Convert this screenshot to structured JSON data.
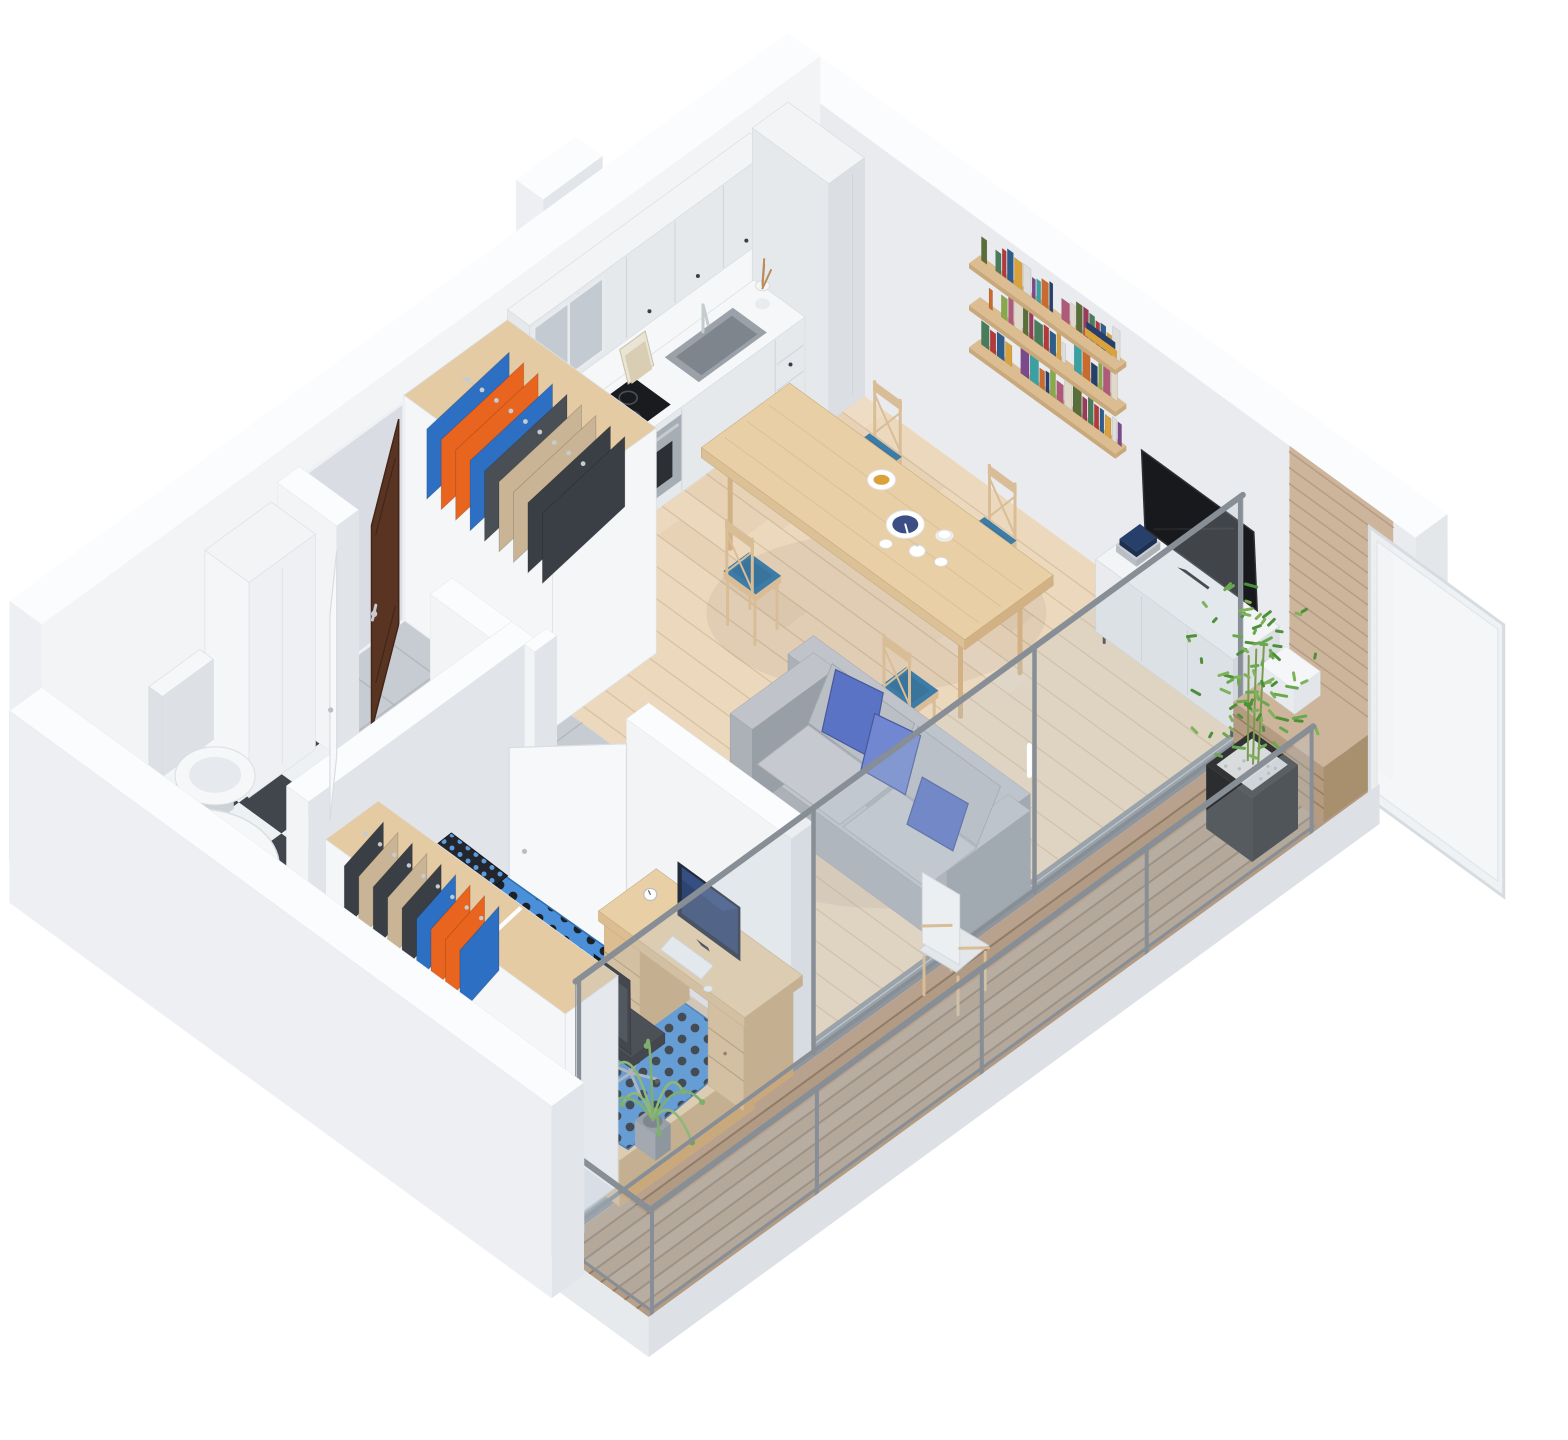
{
  "scene": {
    "kind": "isometric-3d-apartment-floor-plan-render",
    "background": "#ffffff",
    "rooms": [
      "kitchen",
      "living-dining",
      "hallway",
      "bathroom",
      "bedroom",
      "balcony"
    ]
  },
  "colors": {
    "bg": "#ffffff",
    "wallTop": "#fbfcfd",
    "wallInnerTL": "#f3f4f6",
    "wallInnerTR": "#e9ebee",
    "wallEnd": "#e4e7ea",
    "wallOuterFront": "#edeff2",
    "wallOuterShade": "#e2e5e9",
    "slabEdge": "#e7eaed",
    "partTop": "#fbfcfd",
    "partFace": "#f2f4f6",
    "partSide": "#e1e4e8",
    "floorWood": "#ecd8bd",
    "plankLine": "#d9c2a3",
    "tileBase": "#c6ccd1",
    "tileLine": "#b3b9bf",
    "checkerDark": "#41464d",
    "checkerLight": "#eef1f3",
    "deckBase": "#b29b84",
    "deckLine": "#8d7763",
    "cabinetFront": "#e6e9ec",
    "cabinetSide": "#dbdfe3",
    "cabinetTop": "#f2f4f6",
    "counterTop": "#f5f7f9",
    "glassCabinet": "#c4cad1",
    "cooktop": "#191b1e",
    "burnerRing": "#4a5057",
    "ovenSteel": "#a7adb4",
    "ovenGlass": "#2c2f34",
    "sinkOuter": "#9aa1a8",
    "sinkInner": "#7e858c",
    "chrome": "#c6cbd0",
    "tableWood": "#e8cfa6",
    "tableWoodSide": "#dcc096",
    "tableWoodDark": "#d2b284",
    "chairWood": "#d9bd97",
    "chairBlue": "#3d7ca6",
    "chairBlueDark": "#33688c",
    "sofaBody": "#c0c4ca",
    "sofaShade": "#acb1b8",
    "sofaDark": "#999fa7",
    "pillowBlue": "#5b73c4",
    "pillowBlueLight": "#7187d2",
    "pillowBlueDark": "#47599c",
    "bedBlue": "#4a8fd7",
    "bedBlueEdge": "#2f6fb2",
    "bedDotDark": "#1c2127",
    "pillowDark": "#23262c",
    "pillowDotBlue": "#5a9be0",
    "woodLight": "#e9cfa6",
    "woodMid": "#dcbd92",
    "woodDark": "#c9a87b",
    "woodInterior": "#e5cba4",
    "doorBrown": "#5a3423",
    "doorBrownDark": "#422619",
    "doorWhite": "#f7f8fa",
    "doorWhiteEdge": "#d9dde2",
    "recess": "#d9dde3",
    "tvBlack": "#17191c",
    "tvEdge": "#2e3237",
    "monitorFrame": "#232c3c",
    "monitorScreen": "#2e4470",
    "monitorGlow": "#3d5a94",
    "chairBlack": "#26292e",
    "chairBlackDark": "#1b1d21",
    "chromeLeg": "#aab0b6",
    "planterBlack": "#2b2d2f",
    "planterSide": "#232527",
    "pebbles": "#d9dbdd",
    "green1": "#4e8f3a",
    "green2": "#6aa84f",
    "green3": "#7fb25a",
    "trunk": "#7a9a4e",
    "slatWood": "#cdb59c",
    "slatLine": "#b49b81",
    "railFrame": "#878e95",
    "railGlass": "#bac6d0",
    "frostedGlass": "#eef1f4",
    "frostedFrame": "#d7dce1",
    "fixtureWhite": "#f5f7f9",
    "fixtureShade": "#dde1e5",
    "fixtureInner": "#e6eaee",
    "trackGray": "#8f969d",
    "shadow": "#1f2933"
  },
  "palettes": {
    "books": [
      "#4a7c59",
      "#b23a3a",
      "#2f5d8a",
      "#d9a23c",
      "#dddddd",
      "#7a4a8a",
      "#3aa0a0",
      "#c96a2f",
      "#27406b",
      "#88a84a",
      "#b05a7a",
      "#e0d8c8",
      "#5a6e3a",
      "#9a3b5a"
    ],
    "hall_closet_clothes": [
      "#2d6fc2",
      "#e8641f",
      "#e8651f",
      "#2d6fc2",
      "#4a4e55",
      "#c9b595",
      "#c9b595",
      "#3a3e45",
      "#3a3e45"
    ],
    "bedroom_closet_clothes": [
      "#3a3e45",
      "#c9b595",
      "#3a3e45",
      "#c9b595",
      "#3a3e45",
      "#2d6fc2",
      "#e8641f",
      "#e8641f",
      "#2d6fc2"
    ]
  },
  "objects": {
    "kitchen": [
      "upper-cabinets",
      "base-cabinets",
      "cooktop",
      "oven",
      "sink",
      "tall-cabinet",
      "cookbook",
      "utensil-jar"
    ],
    "living": [
      "dining-table",
      "dining-chairs",
      "tableware",
      "bookshelf",
      "tv-sideboard",
      "tv",
      "sofa",
      "blue-pillows"
    ],
    "hallway": [
      "entrance-door",
      "open-wardrobe",
      "tile-floor"
    ],
    "bathroom": [
      "tall-cabinet",
      "toilet",
      "bathtub",
      "checker-floor"
    ],
    "bedroom": [
      "double-bed",
      "desk",
      "monitor",
      "office-chair",
      "palm-plant",
      "open-wardrobe"
    ],
    "balcony": [
      "deck",
      "slat-bench",
      "planter-bamboo",
      "shell-chair",
      "frosted-screen",
      "glass-railing"
    ]
  }
}
